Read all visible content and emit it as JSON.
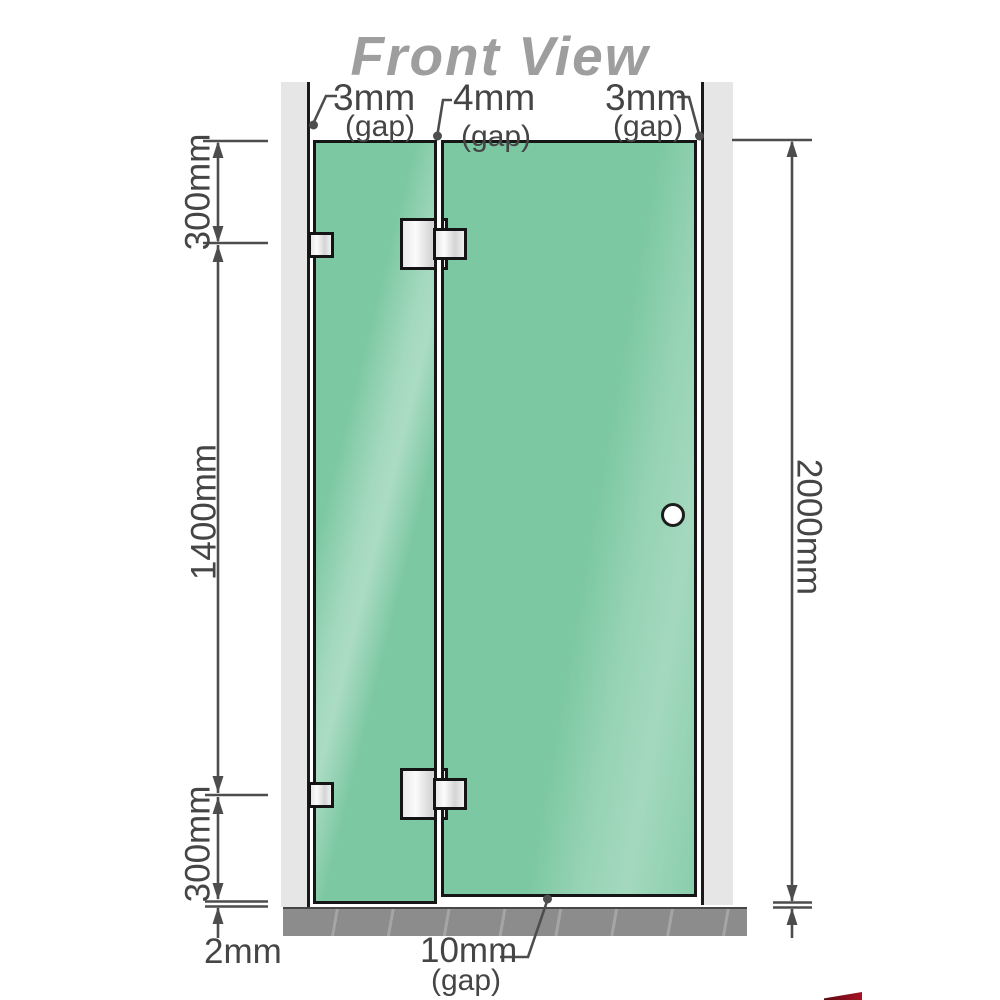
{
  "title": "Front View",
  "labels": {
    "gap_left": {
      "value": "3mm",
      "suffix": "(gap)"
    },
    "gap_middle": {
      "value": "4mm",
      "suffix": "(gap)"
    },
    "gap_right": {
      "value": "3mm",
      "suffix": "(gap)"
    },
    "gap_bottom": {
      "value": "10mm",
      "suffix": "(gap)"
    },
    "height_top_segment": "300mm",
    "height_middle_segment": "1400mm",
    "height_bottom_segment": "300mm",
    "floor_gap": "2mm",
    "total_height": "2000mm"
  },
  "components": {
    "left_wall": "wall",
    "right_wall": "wall",
    "fixed_panel": "fixed glass panel",
    "door_panel": "hinged glass door",
    "floor": "floor",
    "knob": "door knob",
    "hinges": "glass-to-glass hinges",
    "brackets": "wall brackets"
  },
  "colors": {
    "glass": "#7cc8a2",
    "glass_highlight": "#b4e4ca",
    "wall": "#e6e6e6",
    "floor": "#8c8c8c",
    "outline": "#161616",
    "dimension_line": "#4d4d4d",
    "text": "#454545",
    "title": "#9e9e9e",
    "knob_fill": "#ffffff",
    "logo_red": "#a51324"
  }
}
